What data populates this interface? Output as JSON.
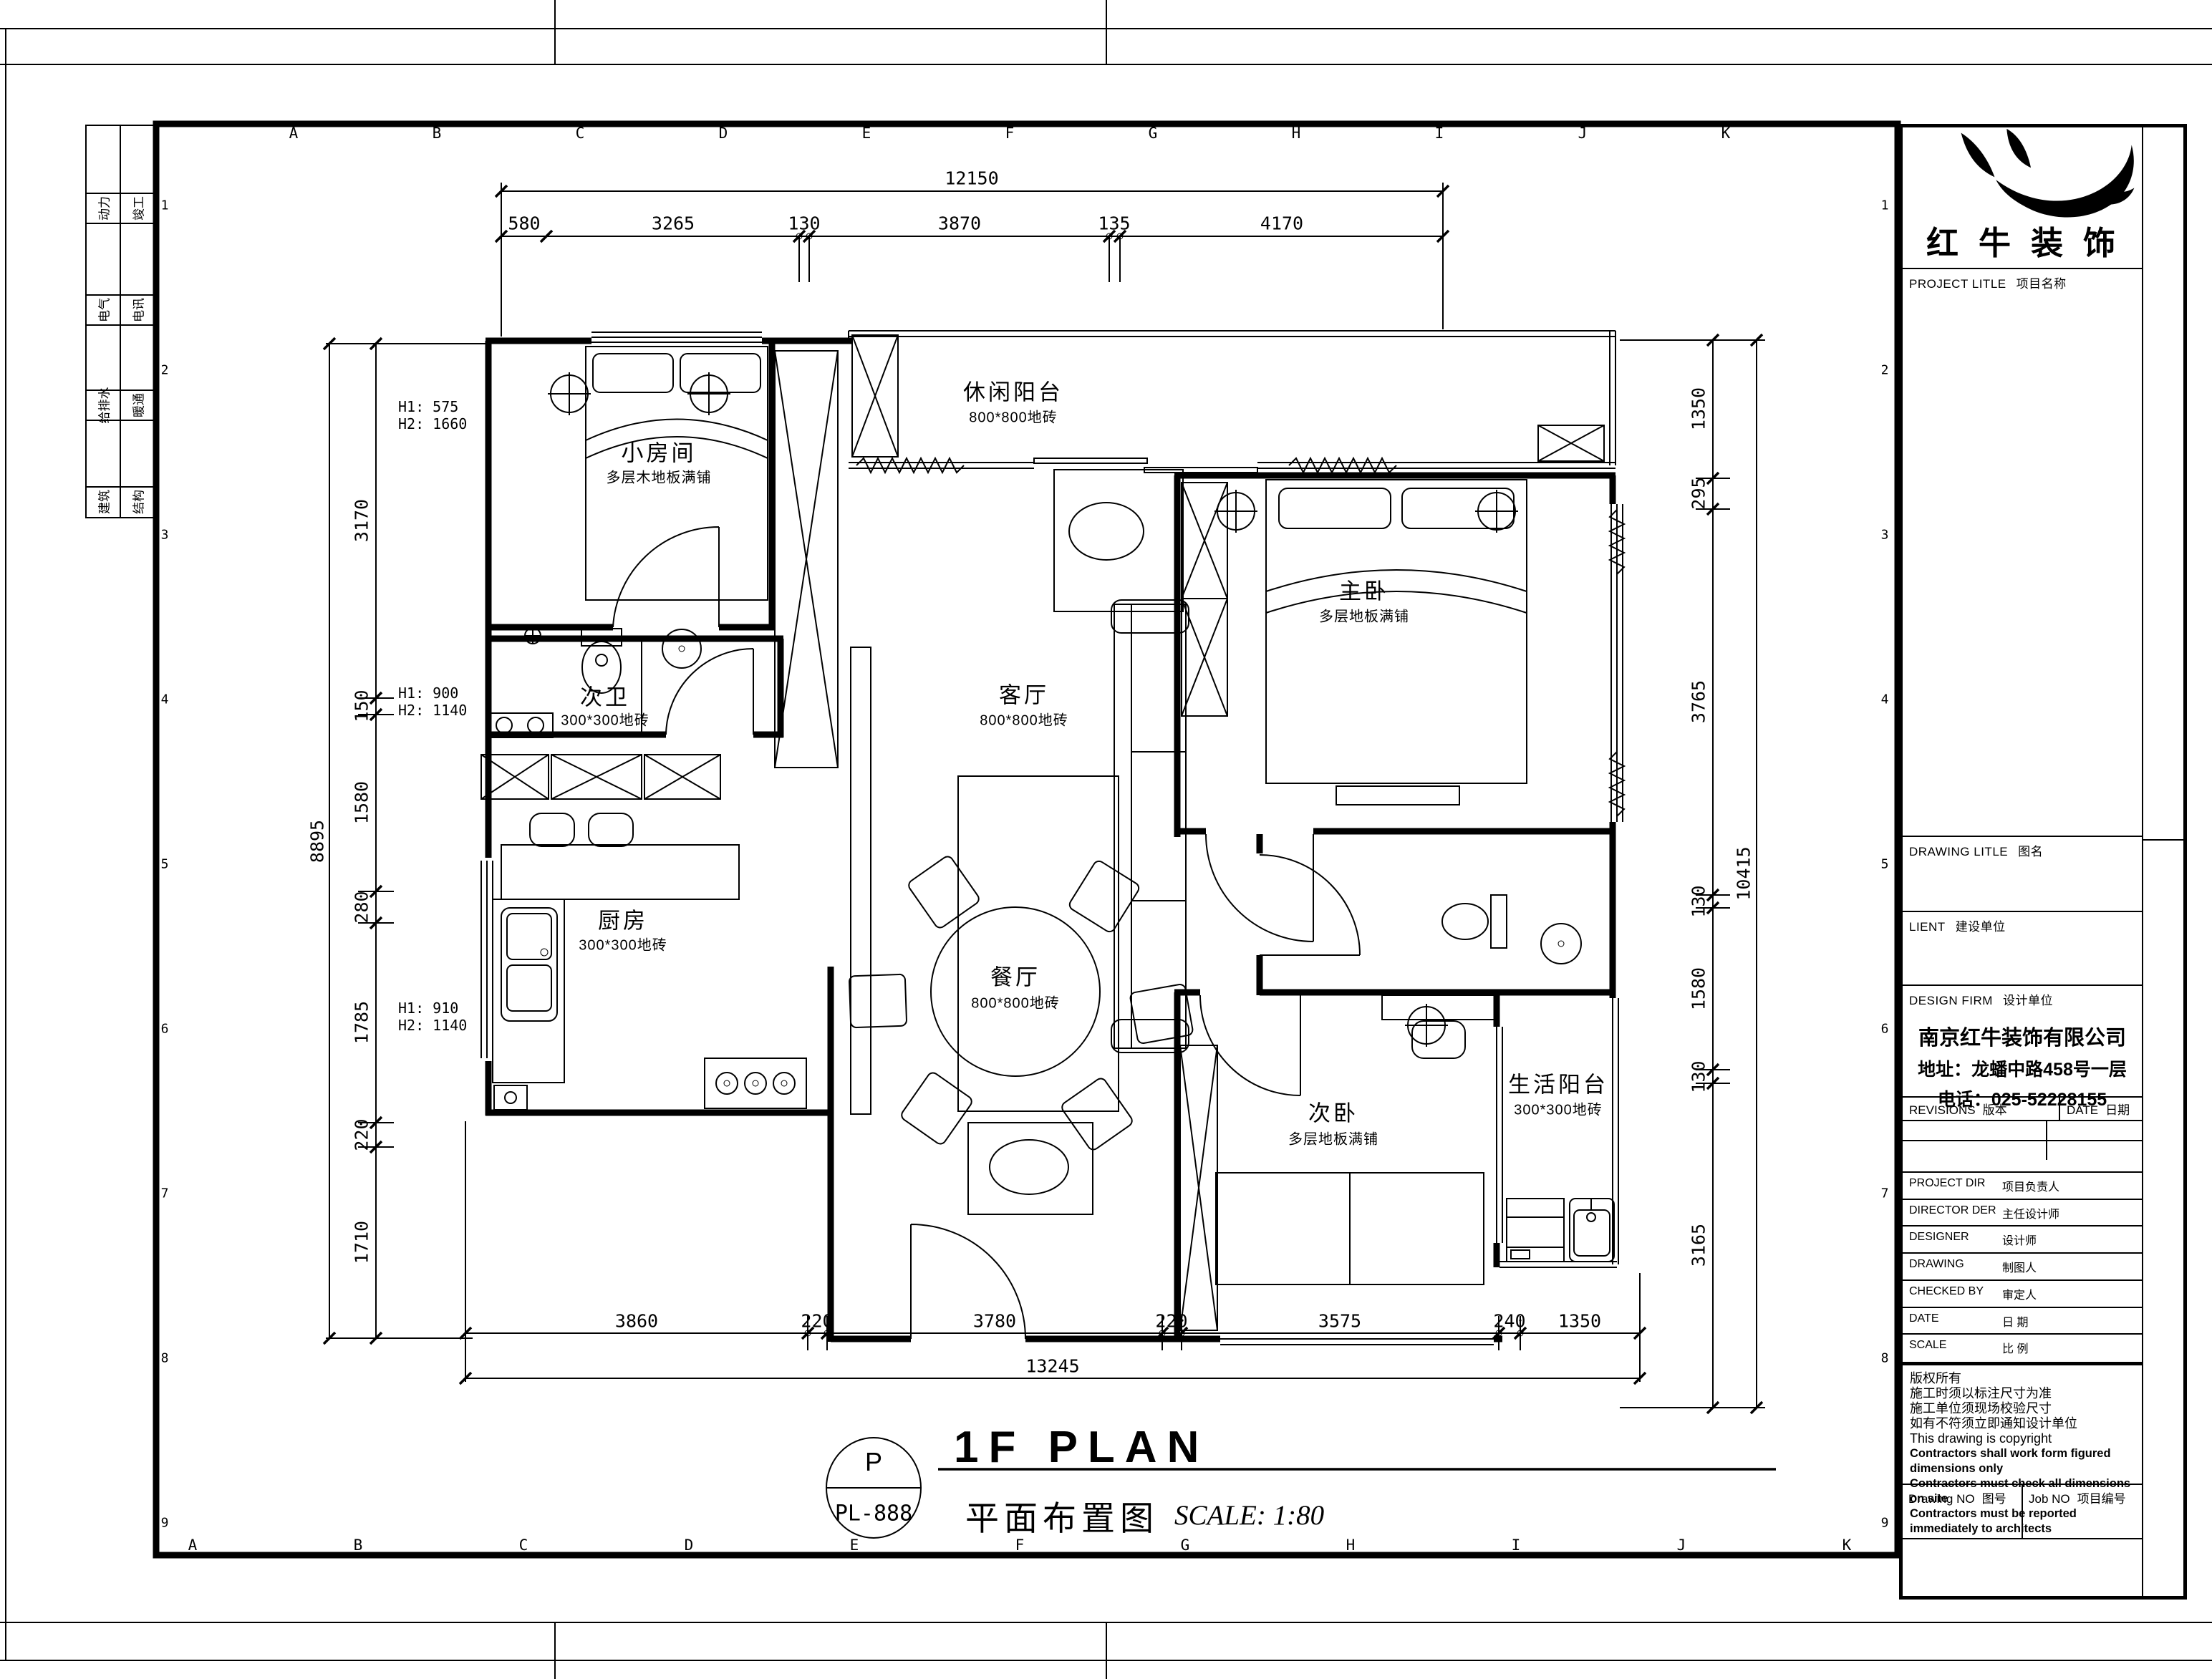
{
  "frame": {
    "letters_top": [
      "A",
      "B",
      "C",
      "D",
      "E",
      "F",
      "G",
      "H",
      "I",
      "J",
      "K"
    ],
    "letters_bottom": [
      "A",
      "B",
      "C",
      "D",
      "E",
      "F",
      "G",
      "H",
      "I",
      "J",
      "K"
    ],
    "rows_left": [
      "1",
      "2",
      "3",
      "4",
      "5",
      "6",
      "7",
      "8",
      "9"
    ],
    "rows_right": [
      "1",
      "2",
      "3",
      "4",
      "5",
      "6",
      "7",
      "8",
      "9"
    ],
    "disciplines": [
      "动力",
      "竣工",
      "电气",
      "电讯",
      "给排水",
      "暖通",
      "建筑",
      "结构"
    ]
  },
  "plan": {
    "rooms": [
      {
        "name": "小房间",
        "finish": "多层木地板满铺"
      },
      {
        "name": "休闲阳台",
        "finish": "800*800地砖"
      },
      {
        "name": "主卧",
        "finish": "多层地板满铺"
      },
      {
        "name": "次卫",
        "finish": "300*300地砖"
      },
      {
        "name": "客厅",
        "finish": "800*800地砖"
      },
      {
        "name": "厨房",
        "finish": "300*300地砖"
      },
      {
        "name": "餐厅",
        "finish": "800*800地砖"
      },
      {
        "name": "次卧",
        "finish": "多层地板满铺"
      },
      {
        "name": "生活阳台",
        "finish": "300*300地砖"
      }
    ],
    "window_notes": [
      {
        "l1": "H1: 575",
        "l2": "H2: 1660"
      },
      {
        "l1": "H1: 900",
        "l2": "H2: 1140"
      },
      {
        "l1": "H1: 910",
        "l2": "H2: 1140"
      }
    ],
    "dims": {
      "top_total": "12150",
      "top": [
        "580",
        "3265",
        "130",
        "3870",
        "135",
        "4170"
      ],
      "bottom_total": "13245",
      "bottom": [
        "3860",
        "220",
        "3780",
        "220",
        "3575",
        "240",
        "1350"
      ],
      "left_total": "8895",
      "left": [
        "3170",
        "150",
        "1580",
        "280",
        "1785",
        "220",
        "1710"
      ],
      "right_total": "10415",
      "right": [
        "1350",
        "295",
        "3765",
        "130",
        "1580",
        "130",
        "3165"
      ]
    },
    "footer": {
      "tag_top": "P",
      "tag_no": "PL-888",
      "title": "1F PLAN",
      "title_cn": "平面布置图",
      "scale": "SCALE: 1:80"
    }
  },
  "titleblock": {
    "logo_text": "红牛装饰",
    "project": {
      "en": "PROJECT LITLE",
      "cn": "项目名称"
    },
    "drawing_title": {
      "en": "DRAWING LITLE",
      "cn": "图名"
    },
    "client": {
      "en": "LIENT",
      "cn": "建设单位"
    },
    "firm": {
      "en": "DESIGN FIRM",
      "cn": "设计单位"
    },
    "company": [
      "南京红牛装饰有限公司",
      "地址：龙蟠中路458号一层",
      "电话：025-52228155"
    ],
    "revisions": {
      "en": "REVISIONS",
      "cn": "版本"
    },
    "date_col": {
      "en": "DATE",
      "cn": "日期"
    },
    "people": [
      {
        "en": "PROJECT DIR",
        "cn": "项目负责人"
      },
      {
        "en": "DIRECTOR DER",
        "cn": "主任设计师"
      },
      {
        "en": "DESIGNER",
        "cn": "设计师"
      },
      {
        "en": "DRAWING",
        "cn": "制图人"
      },
      {
        "en": "CHECKED BY",
        "cn": "审定人"
      },
      {
        "en": "DATE",
        "cn": "日  期"
      },
      {
        "en": "SCALE",
        "cn": "比  例"
      }
    ],
    "copyright": [
      "版权所有",
      "施工时须以标注尺寸为准",
      "施工单位须现场校验尺寸",
      "如有不符须立即通知设计单位",
      "This drawing is copyright",
      "Contractors shall work form figured dimensions only",
      "Contractors must check all dimensions on site",
      "Contractors must be reported immediately to architects"
    ],
    "drawing_no": {
      "en": "Drawing NO",
      "cn": "图号"
    },
    "job_no": {
      "en": "Job NO",
      "cn": "项目编号"
    }
  }
}
